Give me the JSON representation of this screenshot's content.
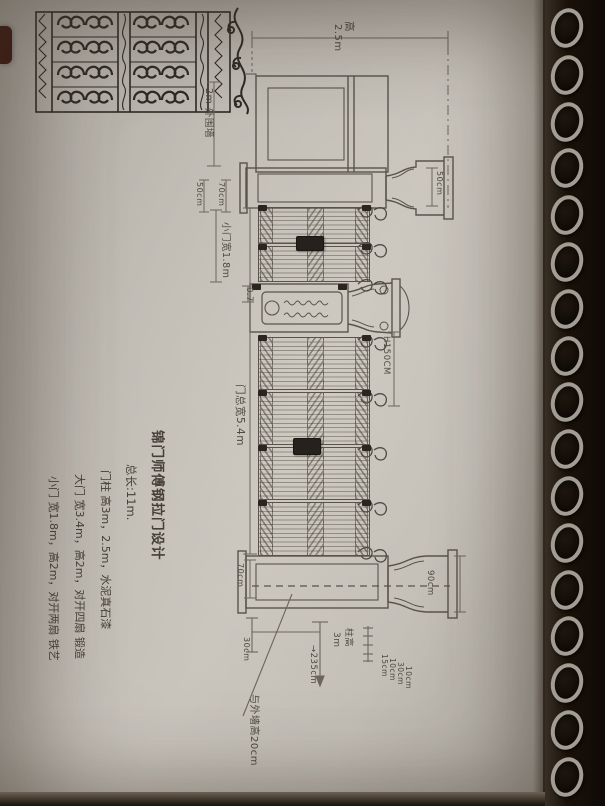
{
  "title_block": {
    "lines": [
      "锦门师傅钢拉门设计",
      "总长:11m.",
      "门柱 高3m，2.5m，水泥真石漆",
      "大门 宽3.4m，高2m，对开四扇 锻造",
      "小门 宽1.8m，高2m，对开两扇 铁艺"
    ]
  },
  "labels": {
    "clear_height_zh": "高",
    "clear_height_val": "2.5m",
    "outer_wall": "2m 外围墙",
    "pillar_w1": "50cm",
    "pillar_w2": "70cm",
    "cap_width": "50cm",
    "small_gate": "小门宽1.8m",
    "offset_07": "0.7",
    "fence_height": "H150CM",
    "gate_width": "门总宽5.4m",
    "base_bracket": "70cm",
    "base_width": "90cm",
    "pillar_height_zh": "柱高",
    "pillar_height_val": "3m",
    "depth_arrow": "→235cm",
    "ground_offset": "30cm",
    "courses": [
      "15cm",
      "10cm",
      "30cm",
      "10cm"
    ],
    "leader_note": "与外墙高20cm"
  },
  "colors": {
    "pencil": "#59534b",
    "ink": "#2e2a25",
    "paper": "#c2beb6",
    "binding": "#1a1209"
  }
}
